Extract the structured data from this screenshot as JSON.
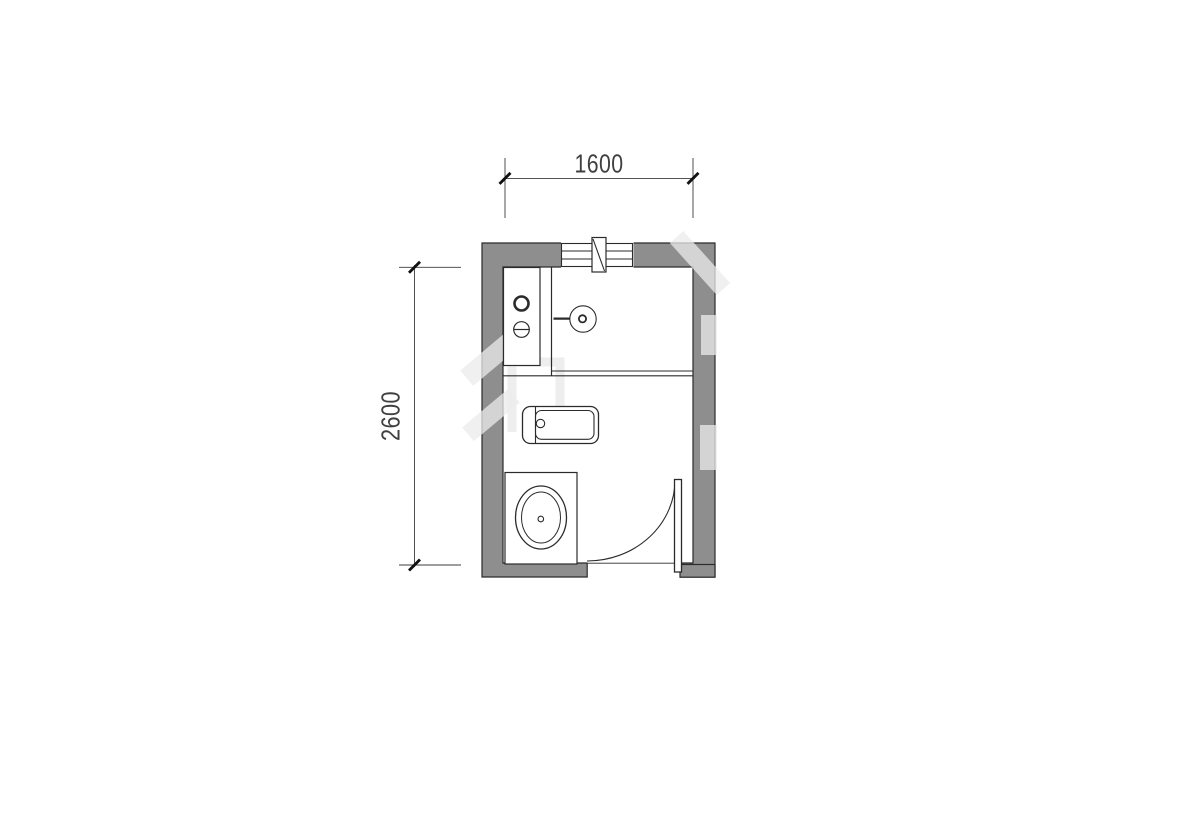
{
  "plan": {
    "kind": "bathroom-floor-plan",
    "dimensions": {
      "width_label": "1600",
      "depth_label": "2600"
    },
    "fixtures": [
      "window",
      "vent-duct",
      "vanity-counter",
      "faucet-valves",
      "shower-head",
      "shower-partition",
      "bathtub",
      "toilet",
      "door-inward-swing"
    ],
    "colors": {
      "wall_fill": "#8e8e8e",
      "line": "#2b2b2b",
      "dim_line": "#3c3c3c",
      "dim_text": "#404040",
      "tick": "#111111",
      "watermark": "rgba(235,235,235,0.75)",
      "background": "#ffffff"
    }
  }
}
